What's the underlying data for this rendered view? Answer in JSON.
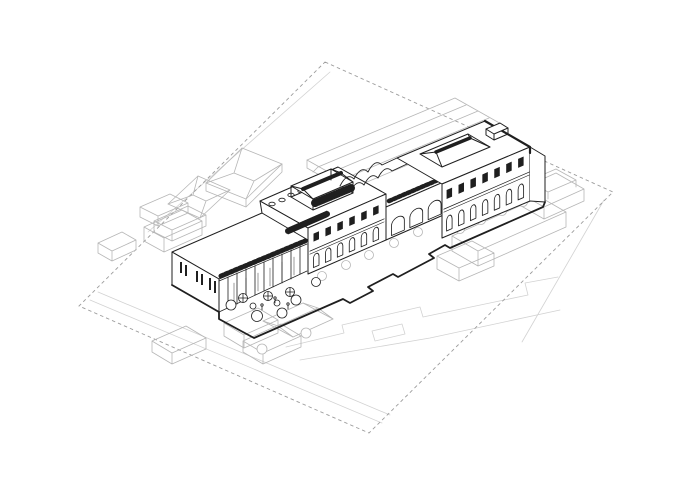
{
  "canvas": {
    "width": 700,
    "height": 495,
    "background": "#ffffff"
  },
  "palette": {
    "ink": "#1f1f1f",
    "context": "#b6b6b6",
    "ground": "#d2d2d2",
    "boundary": "#9c9c9c",
    "paper": "#ffffff"
  },
  "scene": {
    "kind": "axonometric-architectural-site-drawing",
    "elements": [
      "site-boundary",
      "street-lines",
      "context-buildings",
      "main-building",
      "courtyard-with-trees-and-umbrellas",
      "roof-monitor",
      "scalloped-vault-roof",
      "hipped-skylight",
      "street-trees"
    ]
  }
}
